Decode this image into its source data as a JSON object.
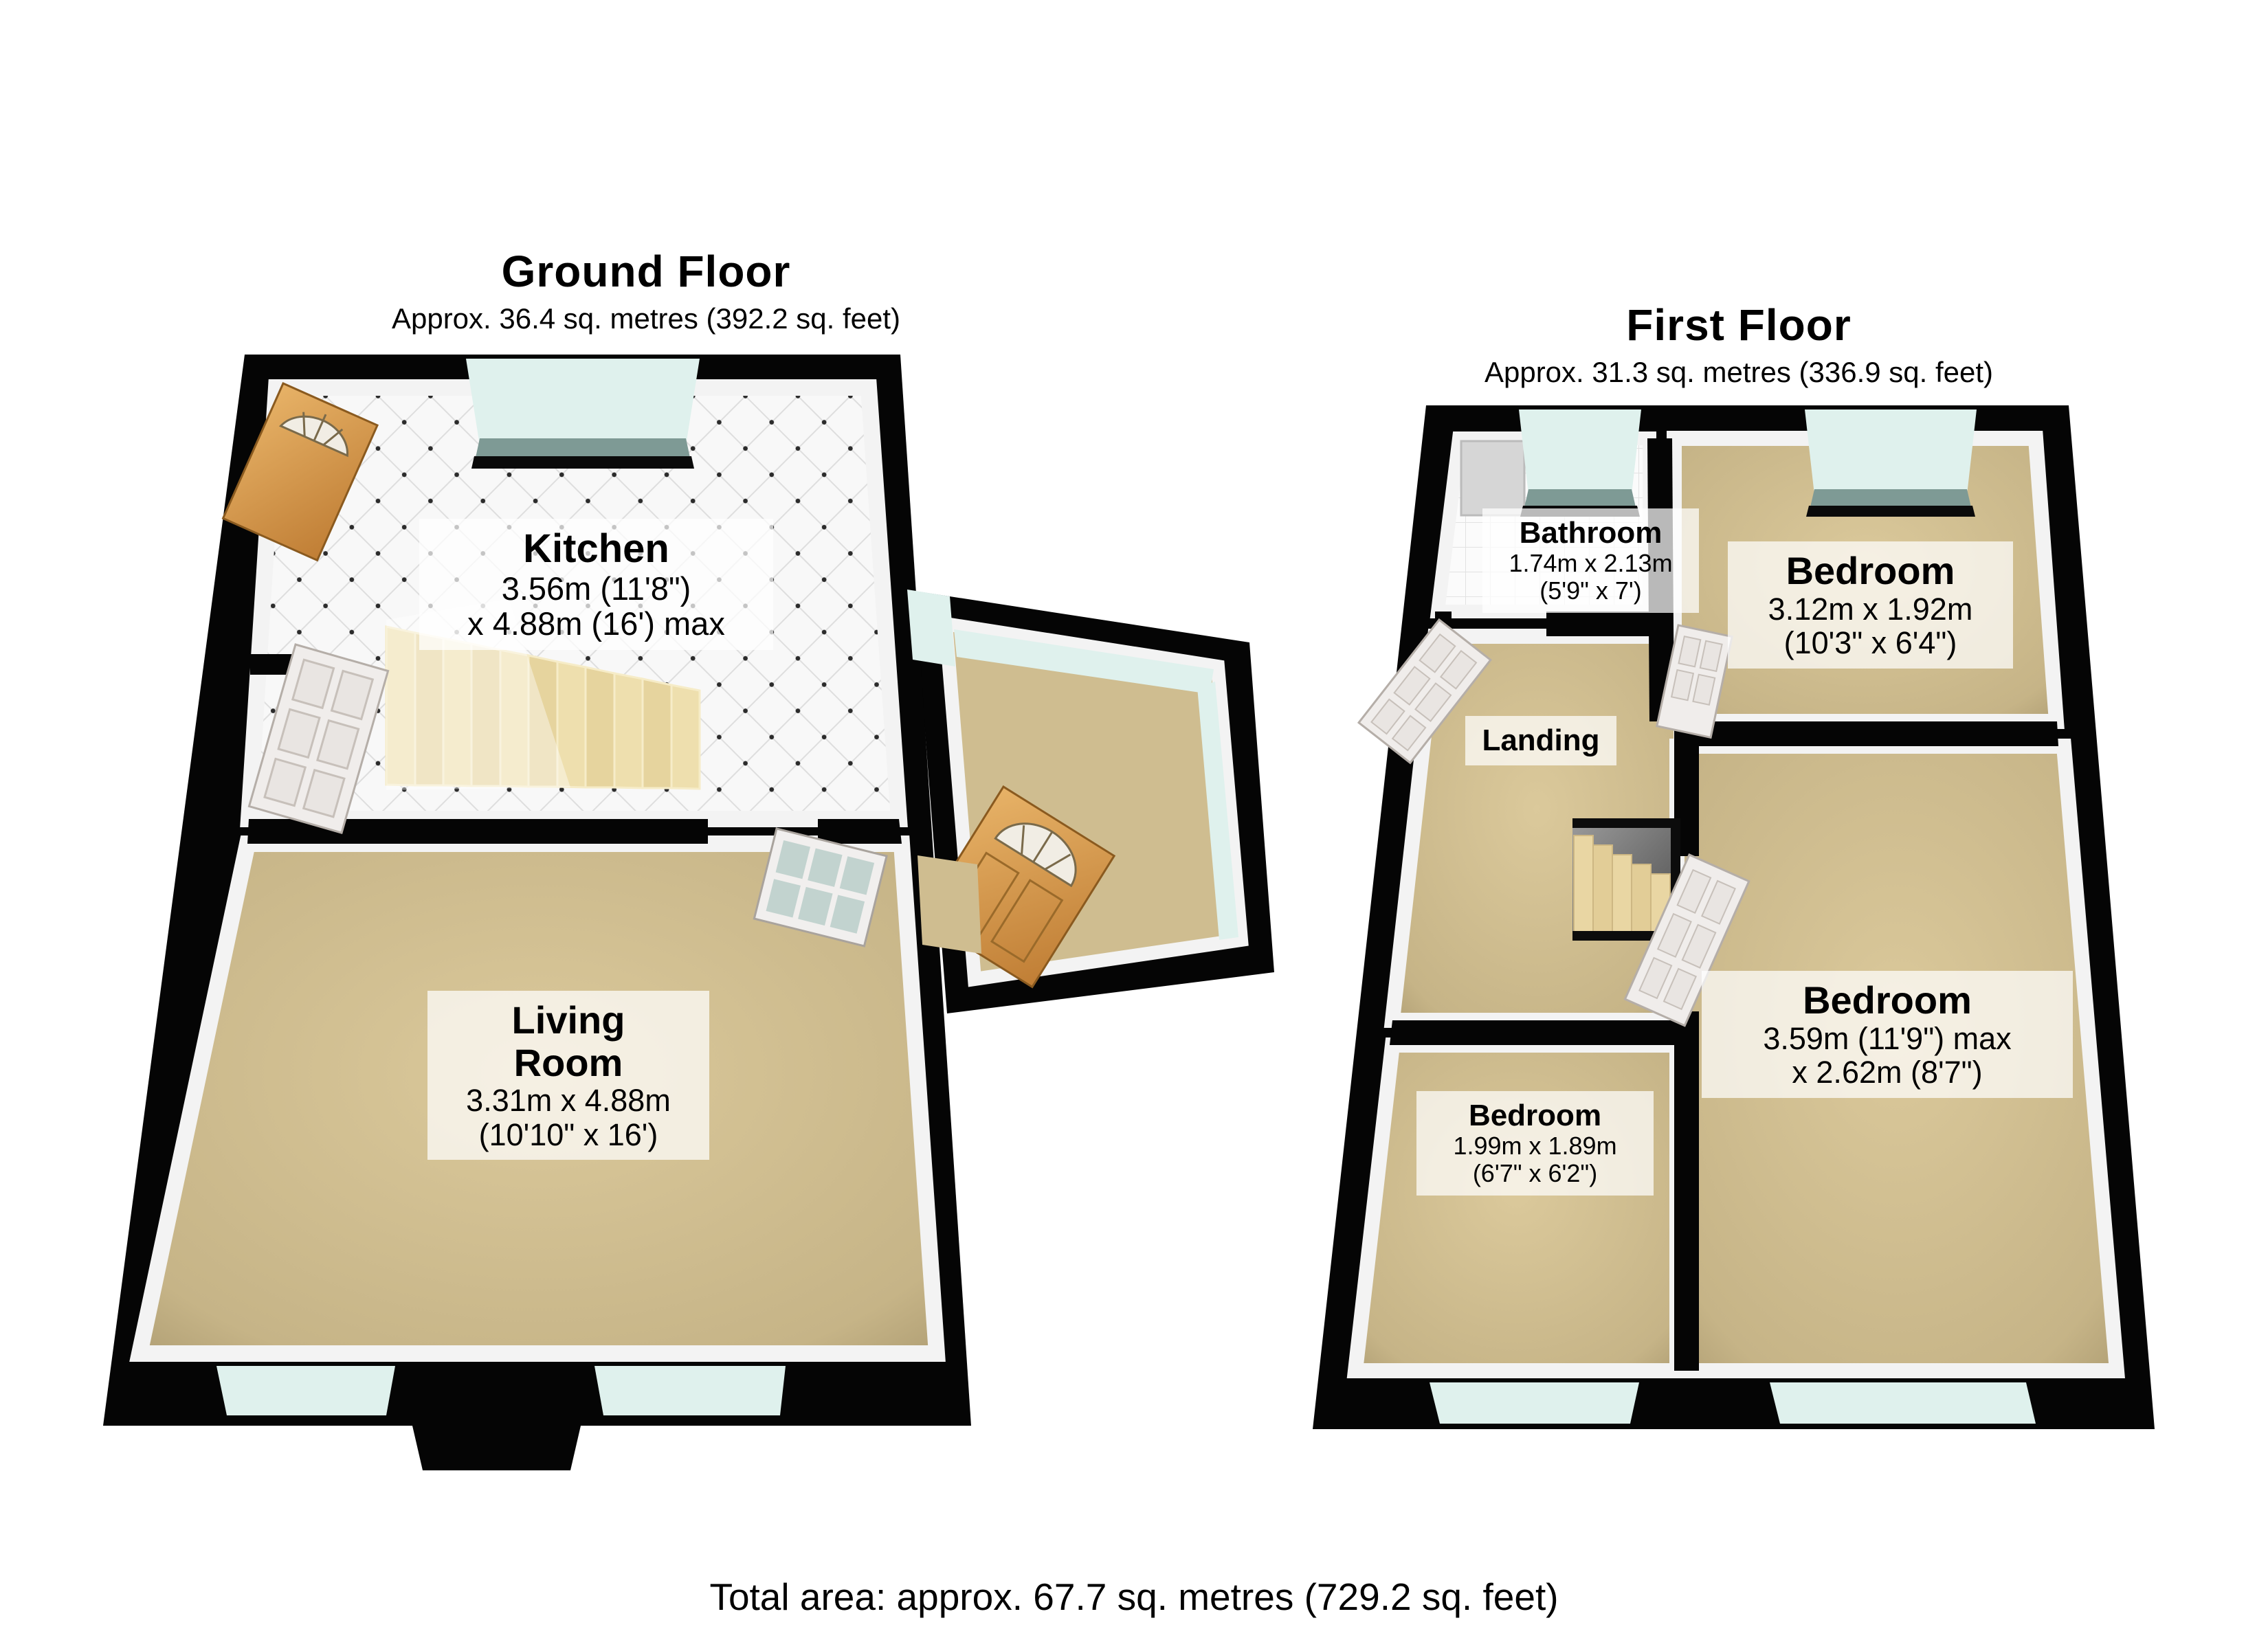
{
  "total_area": "Total area: approx. 67.7 sq. metres (729.2 sq. feet)",
  "floors": {
    "ground": {
      "title": "Ground Floor",
      "subtitle": "Approx. 36.4 sq. metres (392.2 sq. feet)",
      "rooms": {
        "kitchen": {
          "name": "Kitchen",
          "dim1": "3.56m (11'8\")",
          "dim2": "x 4.88m (16') max"
        },
        "living_room": {
          "name_line1": "Living",
          "name_line2": "Room",
          "dim1": "3.31m x 4.88m",
          "dim2": "(10'10\" x 16')"
        }
      }
    },
    "first": {
      "title": "First Floor",
      "subtitle": "Approx. 31.3 sq. metres (336.9 sq. feet)",
      "rooms": {
        "bathroom": {
          "name": "Bathroom",
          "dim1": "1.74m x 2.13m",
          "dim2": "(5'9\" x 7')"
        },
        "bedroom_front": {
          "name": "Bedroom",
          "dim1": "3.12m x 1.92m",
          "dim2": "(10'3\" x 6'4\")"
        },
        "landing": {
          "name": "Landing"
        },
        "bedroom_small": {
          "name": "Bedroom",
          "dim1": "1.99m x 1.89m",
          "dim2": "(6'7\" x 6'2\")"
        },
        "bedroom_rear": {
          "name": "Bedroom",
          "dim1": "3.59m (11'9\") max",
          "dim2": "x 2.62m (8'7\")"
        }
      }
    }
  },
  "colors": {
    "wall": "#050505",
    "carpet": "#cfbd90",
    "kitchen_tile": "#f8f8f8",
    "window_glass": "#dff1ed",
    "window_sill": "#7e9a95",
    "wood_door": "#d1914a",
    "interior_door": "#f0edeb",
    "stairs": "#eadcab",
    "label_background": "rgba(255,255,255,0.72)"
  }
}
